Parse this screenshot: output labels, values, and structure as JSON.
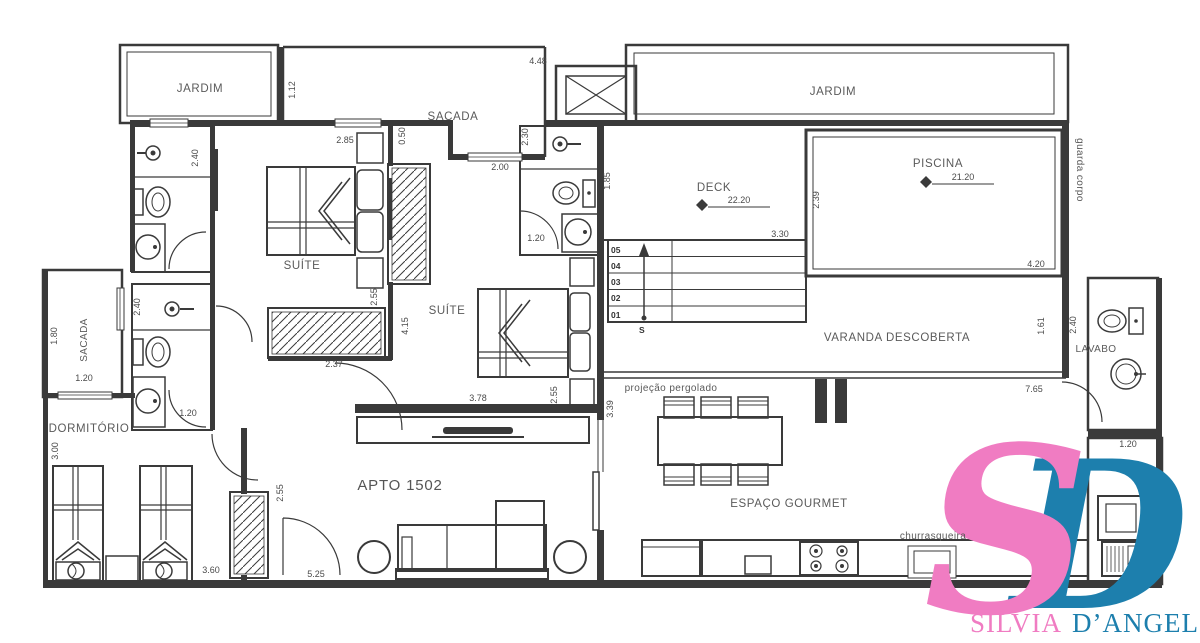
{
  "colors": {
    "line": "#3a3a3a",
    "text": "#5a5a5a",
    "logo_pink": "#f07cc2",
    "logo_blue": "#1d7fad"
  },
  "rooms": {
    "jardim_left": "JARDIM",
    "sacada_top": "SACADA",
    "jardim_right": "JARDIM",
    "deck": {
      "label": "DECK",
      "level": "22.20"
    },
    "piscina": {
      "label": "PISCINA",
      "level": "21.20"
    },
    "guarda_corpo": "guarda corpo",
    "varanda": "VARANDA DESCOBERTA",
    "lavabo": "LAVABO",
    "suite1": "SUÍTE",
    "suite2": "SUÍTE",
    "sacada_left": "SACADA",
    "dormitorio": "DORMITÓRIO",
    "living": "APTO 1502",
    "gourmet": "ESPAÇO GOURMET",
    "pergolado": "projeção pergolado",
    "churrasqueira": "churrasqueira"
  },
  "stairs": {
    "steps": [
      "05",
      "04",
      "03",
      "02",
      "01"
    ],
    "start_label": "S"
  },
  "dims": [
    "4.48",
    "1.12",
    "0.50",
    "2.30",
    "2.00",
    "2.85",
    "2.40",
    "1.85",
    "1.20",
    "3.30",
    "2.39",
    "4.20",
    "2.55",
    "2.40",
    "4.15",
    "2.37",
    "1.20",
    "3.78",
    "2.55",
    "1.80",
    "1.20",
    "3.00",
    "3.60",
    "2.55",
    "5.25",
    "1.61",
    "2.40",
    "7.65",
    "1.20",
    "3.39"
  ],
  "logo": {
    "monogram_s": "S",
    "monogram_d": "D",
    "name_first": "SILVIA",
    "name_last": "D’ANGELO"
  }
}
